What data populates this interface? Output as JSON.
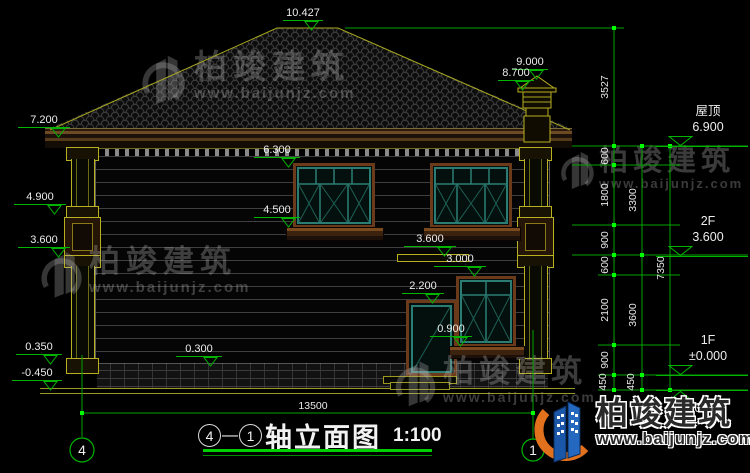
{
  "drawing": {
    "title_axis_left": "4",
    "title_separator": "—",
    "title_axis_right": "1",
    "title_name": "轴立面图",
    "title_scale": "1:100"
  },
  "axis_bubbles": {
    "left": "4",
    "right": "1"
  },
  "levels": {
    "ridge": "10.427",
    "chimney_top": "9.000",
    "chimney_base": "8.700",
    "eave": "7.200",
    "win2_top": "6.300",
    "porch_cap": "4.900",
    "win2_sill": "4.500",
    "floor2_left": "3.600",
    "floor2_mid": "3.600",
    "win1_top": "3.000",
    "door_top": "2.200",
    "win1_sill": "0.900",
    "plinth_left": "0.350",
    "plinth_mid": "0.300",
    "ground_left": "-0.450",
    "roof_label": "屋顶",
    "roof_value": "6.900",
    "f2_label": "2F",
    "f2_value": "3.600",
    "f1_label": "1F",
    "f1_value": "±0.000",
    "ground_right": "-0.450"
  },
  "dims": {
    "roof_height": "3527",
    "seg_600a": "600",
    "seg_1800": "1800",
    "seg_900a": "900",
    "seg_600b": "600",
    "seg_2100": "2100",
    "seg_900b": "900",
    "seg_450a": "450",
    "f2_total": "3300",
    "f1_total": "3600",
    "seg_450b": "450",
    "upper_total": "7350",
    "width_total": "13500"
  },
  "watermark": {
    "brand": "柏竣建筑",
    "site": "www.baijunjz.com"
  },
  "footer_logo": {
    "brand": "柏竣建筑",
    "site": "www.baijunjz.com"
  }
}
